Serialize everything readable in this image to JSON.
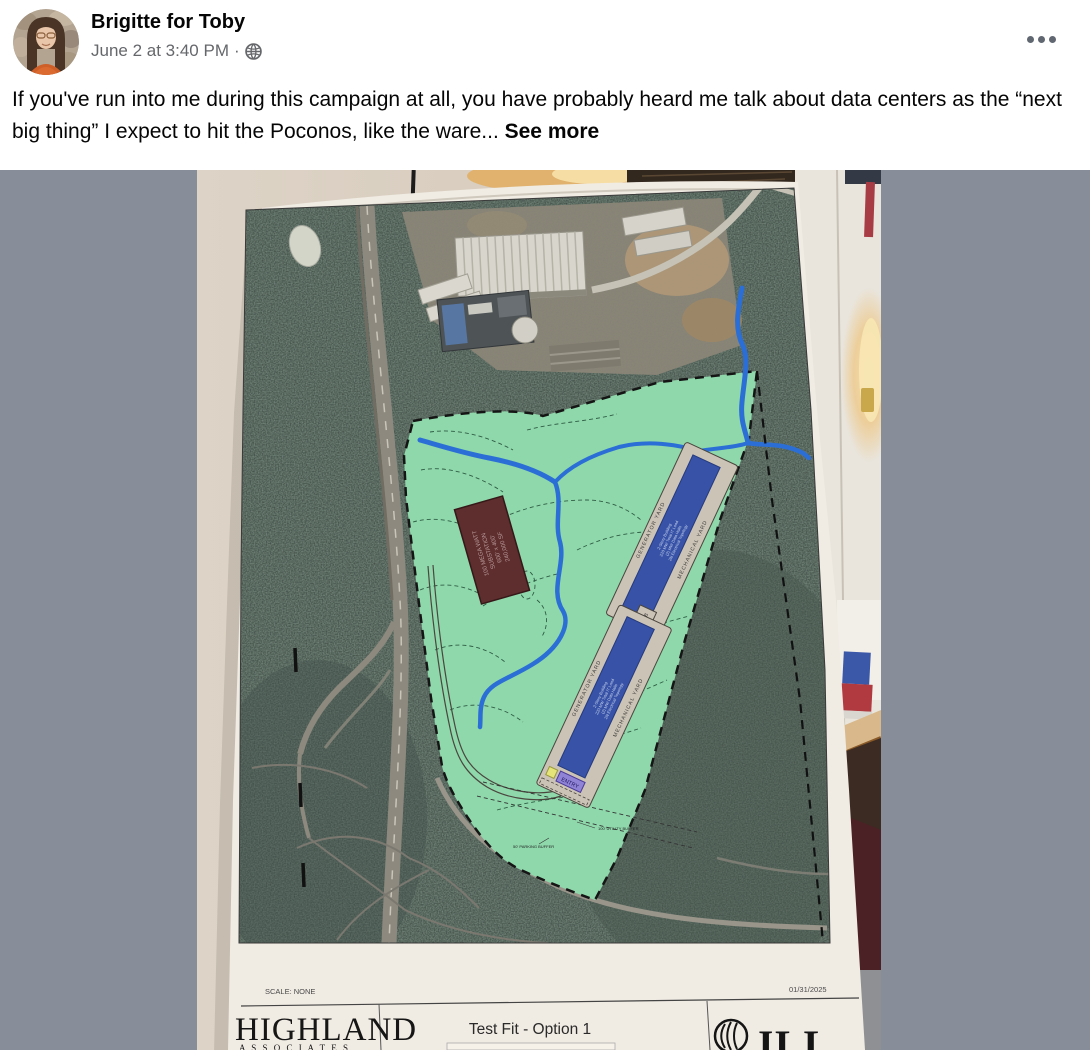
{
  "header": {
    "author": "Brigitte for Toby",
    "timestamp": "June 2 at 3:40 PM",
    "dot": "·"
  },
  "post": {
    "body": "If you've run into me during this campaign at all, you have probably heard me talk about data centers as the “next big thing” I expect to hit the Poconos, like the ware...",
    "see_more": "See more"
  },
  "map": {
    "scale_label": "SCALE: NONE",
    "date": "01/31/2025",
    "firm_name": "HIGHLAND",
    "firm_sub": "A S S O C I A T E S",
    "sheet_title": "Test Fit - Option 1",
    "logo_text": "JLL",
    "generator_yard": "GENERATOR YARD",
    "mechanical_yard": "MECHANICAL YARD",
    "entry_label": "ENTRY",
    "lb_label": "LB",
    "bldg_line1": "2-Story Building",
    "bldg_line2": "220 MW Total IT Load",
    "bldg_line3": "(2) MW Data Halls",
    "bldg_line4": "2N Electrical Topology",
    "substation_line1": "100 MEGA WATT",
    "substation_line2": "SUBSTATION",
    "substation_line3": "600' x 400'",
    "substation_line4": "240,000 SF",
    "buffer1": "100' UTILITY BUFFER",
    "buffer2": "50' PARKING BUFFER"
  },
  "colors": {
    "matte_gray": "#888e99",
    "parcel_green": "#8fd8ab",
    "stream_blue": "#2b6fd6",
    "building_blue": "#3752a6",
    "substation_maroon": "#5e2d2d",
    "entry_purple": "#8f83d6",
    "text_primary": "#050505",
    "text_secondary": "#65676b"
  }
}
